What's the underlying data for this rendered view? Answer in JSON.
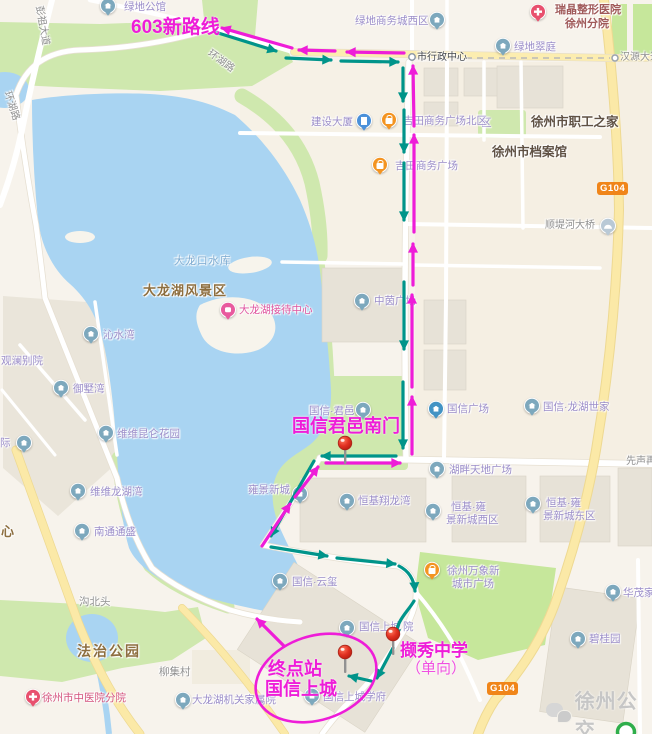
{
  "route": {
    "new_route_label": "603新路线",
    "south_gate_label": "国信君邑南门",
    "terminus_line1": "终点站",
    "terminus_line2": "国信上城",
    "school_label": "撷秀中学",
    "school_note": "（单向）"
  },
  "badges": {
    "g104": "G104"
  },
  "watermark": {
    "text": "徐州公交",
    "icon": "chat-bubbles-icon"
  },
  "colors": {
    "outbound_route": "#00948a",
    "return_route": "#ee1dd8",
    "water": "#a9d4f2",
    "park_green": "#cfe8ae",
    "major_road_yellow": "#fbe9a7",
    "pin_red": "#e23222",
    "badge_orange": "#f08519"
  },
  "map_labels": [
    {
      "text": "彭祖大道",
      "x": 44,
      "y": 5,
      "c": "road",
      "r": 80,
      "name": "road-label-pengzu-avenue"
    },
    {
      "text": "环湖路",
      "x": 212,
      "y": 48,
      "c": "road",
      "r": 36,
      "name": "road-label-huanhu-road"
    },
    {
      "text": "环湖路",
      "x": 12,
      "y": 90,
      "c": "road",
      "r": 72,
      "name": "road-label-huanhu-road-west"
    },
    {
      "text": "汉源大道",
      "x": 620,
      "y": 52,
      "c": "road",
      "name": "road-label-hanyuan-avenue"
    },
    {
      "text": "市行政中心",
      "x": 417,
      "y": 52,
      "c": "dark",
      "name": "label-city-admin-center"
    },
    {
      "text": "绿地公馆",
      "x": 124,
      "y": 2,
      "c": "purple",
      "name": "label-lvdi-mansion"
    },
    {
      "text": "绿地商务城西区",
      "x": 355,
      "y": 16,
      "c": "purple",
      "name": "label-lvdi-business-west"
    },
    {
      "text": "绿地翠庭",
      "x": 514,
      "y": 42,
      "c": "purple",
      "name": "label-lvdi-cuiting"
    },
    {
      "text": "瑞晶整形医院",
      "x": 555,
      "y": 4,
      "c": "maroon",
      "name": "label-ruijing-hospital-1"
    },
    {
      "text": "徐州分院",
      "x": 565,
      "y": 18,
      "c": "maroon",
      "name": "label-ruijing-hospital-2"
    },
    {
      "text": "区",
      "x": 481,
      "y": 118,
      "c": "purple",
      "name": "label-district-partial"
    },
    {
      "text": "吉田商务广场北区",
      "x": 403,
      "y": 116,
      "c": "purple",
      "name": "label-jitian-plaza-north"
    },
    {
      "text": "建设大厦",
      "x": 311,
      "y": 117,
      "c": "purple",
      "name": "label-jianshe-tower"
    },
    {
      "text": "吉田商务广场",
      "x": 395,
      "y": 161,
      "c": "purple",
      "name": "label-jitian-plaza"
    },
    {
      "text": "徐州市职工之家",
      "x": 531,
      "y": 115,
      "c": "gov",
      "name": "label-workers-home"
    },
    {
      "text": "徐州市档案馆",
      "x": 492,
      "y": 145,
      "c": "gov",
      "name": "label-city-archives"
    },
    {
      "text": "顺堤河大桥",
      "x": 545,
      "y": 220,
      "c": "road",
      "name": "label-shundihe-bridge"
    },
    {
      "text": "大龙口水库",
      "x": 174,
      "y": 256,
      "c": "water",
      "name": "label-dalongkou-reservoir"
    },
    {
      "text": "大龙湖风景区",
      "x": 143,
      "y": 284,
      "c": "park",
      "name": "label-dalonghu-scenic-area"
    },
    {
      "text": "大龙湖接待中心",
      "x": 239,
      "y": 305,
      "c": "scenic",
      "name": "label-dalonghu-reception"
    },
    {
      "text": "中茵广场",
      "x": 374,
      "y": 296,
      "c": "purple",
      "name": "label-zhongyin-plaza"
    },
    {
      "text": "沁水湾",
      "x": 103,
      "y": 330,
      "c": "purple",
      "name": "label-qinshuiwan"
    },
    {
      "text": "观澜别院",
      "x": 1,
      "y": 356,
      "c": "purple",
      "name": "label-guanlan-courtyard"
    },
    {
      "text": "御墅湾",
      "x": 73,
      "y": 384,
      "c": "purple",
      "name": "label-yushuwan"
    },
    {
      "text": "维维昆仑花园",
      "x": 117,
      "y": 429,
      "c": "purple",
      "name": "label-weiwei-kunlun-garden"
    },
    {
      "text": "际",
      "x": 0,
      "y": 438,
      "c": "purple",
      "name": "label-ji-partial"
    },
    {
      "text": "维维龙湖湾",
      "x": 90,
      "y": 487,
      "c": "purple",
      "name": "label-weiwei-longhuwan"
    },
    {
      "text": "南通通盛",
      "x": 94,
      "y": 527,
      "c": "purple",
      "name": "label-nantong-tongsheng"
    },
    {
      "text": "心",
      "x": 1,
      "y": 525,
      "c": "park",
      "name": "label-xin-partial"
    },
    {
      "text": "雍景新城",
      "x": 248,
      "y": 485,
      "c": "purple",
      "name": "label-yongjing-newtown"
    },
    {
      "text": "恒基翔龙湾",
      "x": 358,
      "y": 496,
      "c": "purple",
      "name": "label-hengji-xianglongwan"
    },
    {
      "text": "恒基·雍",
      "x": 451,
      "y": 502,
      "c": "purple",
      "name": "label-hengji-yong-west-1"
    },
    {
      "text": "景新城西区",
      "x": 446,
      "y": 515,
      "c": "purple",
      "name": "label-hengji-yong-west-2"
    },
    {
      "text": "恒基·雍",
      "x": 546,
      "y": 498,
      "c": "purple",
      "name": "label-hengji-yong-east-1"
    },
    {
      "text": "景新城东区",
      "x": 543,
      "y": 511,
      "c": "purple",
      "name": "label-hengji-yong-east-2"
    },
    {
      "text": "国信·君邑",
      "x": 309,
      "y": 406,
      "c": "purple",
      "name": "label-guoxin-junyi"
    },
    {
      "text": "国信广场",
      "x": 447,
      "y": 404,
      "c": "purple",
      "name": "label-guoxin-plaza"
    },
    {
      "text": "国信·龙湖世家",
      "x": 543,
      "y": 402,
      "c": "purple",
      "name": "label-guoxin-longhu-shijia"
    },
    {
      "text": "湖畔天地广场",
      "x": 449,
      "y": 465,
      "c": "purple",
      "name": "label-hupan-tiandi-plaza"
    },
    {
      "text": "先声再",
      "x": 626,
      "y": 456,
      "c": "road",
      "name": "label-xiansheng-partial"
    },
    {
      "text": "徐州万象新",
      "x": 447,
      "y": 566,
      "c": "purple",
      "name": "label-wanxiang-plaza-1"
    },
    {
      "text": "城市广场",
      "x": 452,
      "y": 579,
      "c": "purple",
      "name": "label-wanxiang-plaza-2"
    },
    {
      "text": "国信·云玺",
      "x": 292,
      "y": 577,
      "c": "purple",
      "name": "label-guoxin-yunxi"
    },
    {
      "text": "国信上城",
      "x": 359,
      "y": 622,
      "c": "purple",
      "name": "label-guoxin-shangcheng-part1"
    },
    {
      "text": "院",
      "x": 403,
      "y": 622,
      "c": "purple",
      "name": "label-guoxin-shangcheng-part2"
    },
    {
      "text": "国信上城学府",
      "x": 323,
      "y": 692,
      "c": "purple",
      "name": "label-guoxin-shangcheng-xuefu"
    },
    {
      "text": "沟北头",
      "x": 79,
      "y": 597,
      "c": "village",
      "name": "label-goubeitou"
    },
    {
      "text": "法治公园",
      "x": 77,
      "y": 644,
      "c": "parkLg",
      "name": "label-fazhi-park"
    },
    {
      "text": "柳集村",
      "x": 159,
      "y": 667,
      "c": "village",
      "name": "label-liuji-village"
    },
    {
      "text": "徐州市中医院分院",
      "x": 42,
      "y": 693,
      "c": "hosp",
      "name": "label-tcm-hospital-branch"
    },
    {
      "text": "大龙湖机关家属院",
      "x": 192,
      "y": 695,
      "c": "purple",
      "name": "label-dalonghu-staff-quarters"
    },
    {
      "text": "碧桂园",
      "x": 589,
      "y": 634,
      "c": "purple",
      "name": "label-biguiyuan"
    },
    {
      "text": "华茂家园",
      "x": 623,
      "y": 588,
      "c": "purple",
      "name": "label-huamao-home"
    }
  ],
  "map_icons": [
    {
      "kind": "house-icon",
      "x": 108,
      "y": 7
    },
    {
      "kind": "house-icon",
      "x": 437,
      "y": 21
    },
    {
      "kind": "house-icon",
      "x": 503,
      "y": 47
    },
    {
      "kind": "house-icon",
      "x": 91,
      "y": 335
    },
    {
      "kind": "house-icon",
      "x": 61,
      "y": 389
    },
    {
      "kind": "house-icon",
      "x": 106,
      "y": 434
    },
    {
      "kind": "house-icon",
      "x": 24,
      "y": 444
    },
    {
      "kind": "house-icon",
      "x": 78,
      "y": 492
    },
    {
      "kind": "house-icon",
      "x": 82,
      "y": 532
    },
    {
      "kind": "house-icon",
      "x": 300,
      "y": 495
    },
    {
      "kind": "house-icon",
      "x": 347,
      "y": 502
    },
    {
      "kind": "house-icon",
      "x": 433,
      "y": 512
    },
    {
      "kind": "house-icon",
      "x": 533,
      "y": 505
    },
    {
      "kind": "house-icon",
      "x": 363,
      "y": 411
    },
    {
      "kind": "house-icon",
      "x": 532,
      "y": 407
    },
    {
      "kind": "house-icon",
      "x": 437,
      "y": 470
    },
    {
      "kind": "house-icon",
      "x": 362,
      "y": 302
    },
    {
      "kind": "house-icon",
      "x": 280,
      "y": 582
    },
    {
      "kind": "house-icon",
      "x": 347,
      "y": 629
    },
    {
      "kind": "house-icon",
      "x": 312,
      "y": 697
    },
    {
      "kind": "house-icon",
      "x": 578,
      "y": 640
    },
    {
      "kind": "house-icon",
      "x": 613,
      "y": 593
    },
    {
      "kind": "house-icon",
      "x": 183,
      "y": 701
    },
    {
      "kind": "mall-icon",
      "x": 436,
      "y": 410
    },
    {
      "kind": "shop-icon",
      "x": 389,
      "y": 121
    },
    {
      "kind": "shop-icon",
      "x": 380,
      "y": 166
    },
    {
      "kind": "shop-icon",
      "x": 432,
      "y": 571
    },
    {
      "kind": "building-icon",
      "x": 364,
      "y": 122
    },
    {
      "kind": "hospital-icon",
      "x": 538,
      "y": 13
    },
    {
      "kind": "hospital-icon",
      "x": 33,
      "y": 698
    },
    {
      "kind": "scenic-icon",
      "x": 228,
      "y": 311
    },
    {
      "kind": "bridge-icon",
      "x": 608,
      "y": 227
    }
  ]
}
